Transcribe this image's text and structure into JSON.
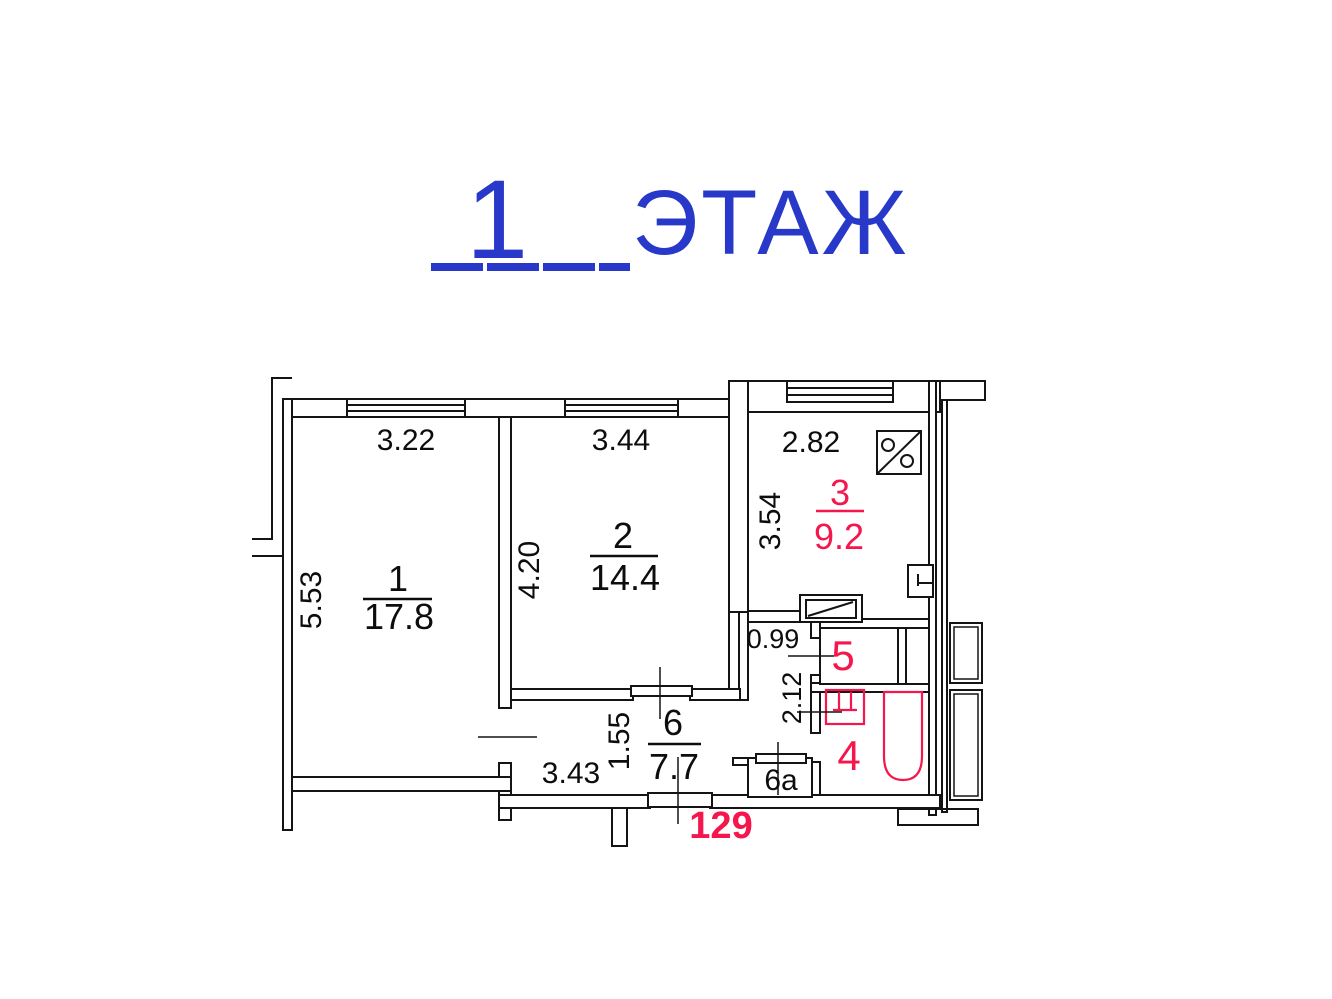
{
  "title": {
    "floor_number": "1",
    "floor_word": "ЭТАЖ"
  },
  "apartment_number": "129",
  "colors": {
    "accent_blue": "#2838c8",
    "accent_red": "#f5164d",
    "line_black": "#141414"
  },
  "rooms": {
    "r1": {
      "number": "1",
      "area": "17.8",
      "dim_top": "3.22",
      "dim_side": "5.53"
    },
    "r2": {
      "number": "2",
      "area": "14.4",
      "dim_top": "3.44",
      "dim_side": "4.20"
    },
    "r3": {
      "number": "3",
      "area": "9.2",
      "dim_top": "2.82",
      "dim_side": "3.54"
    },
    "r4": {
      "number": "4",
      "dim_side": "2.12"
    },
    "r5": {
      "number": "5",
      "dim_entry": "0.99"
    },
    "r6": {
      "number": "6",
      "area": "7.7",
      "dim_bottom": "3.43",
      "dim_side": "1.55"
    },
    "r6a": {
      "number": "6a"
    }
  }
}
